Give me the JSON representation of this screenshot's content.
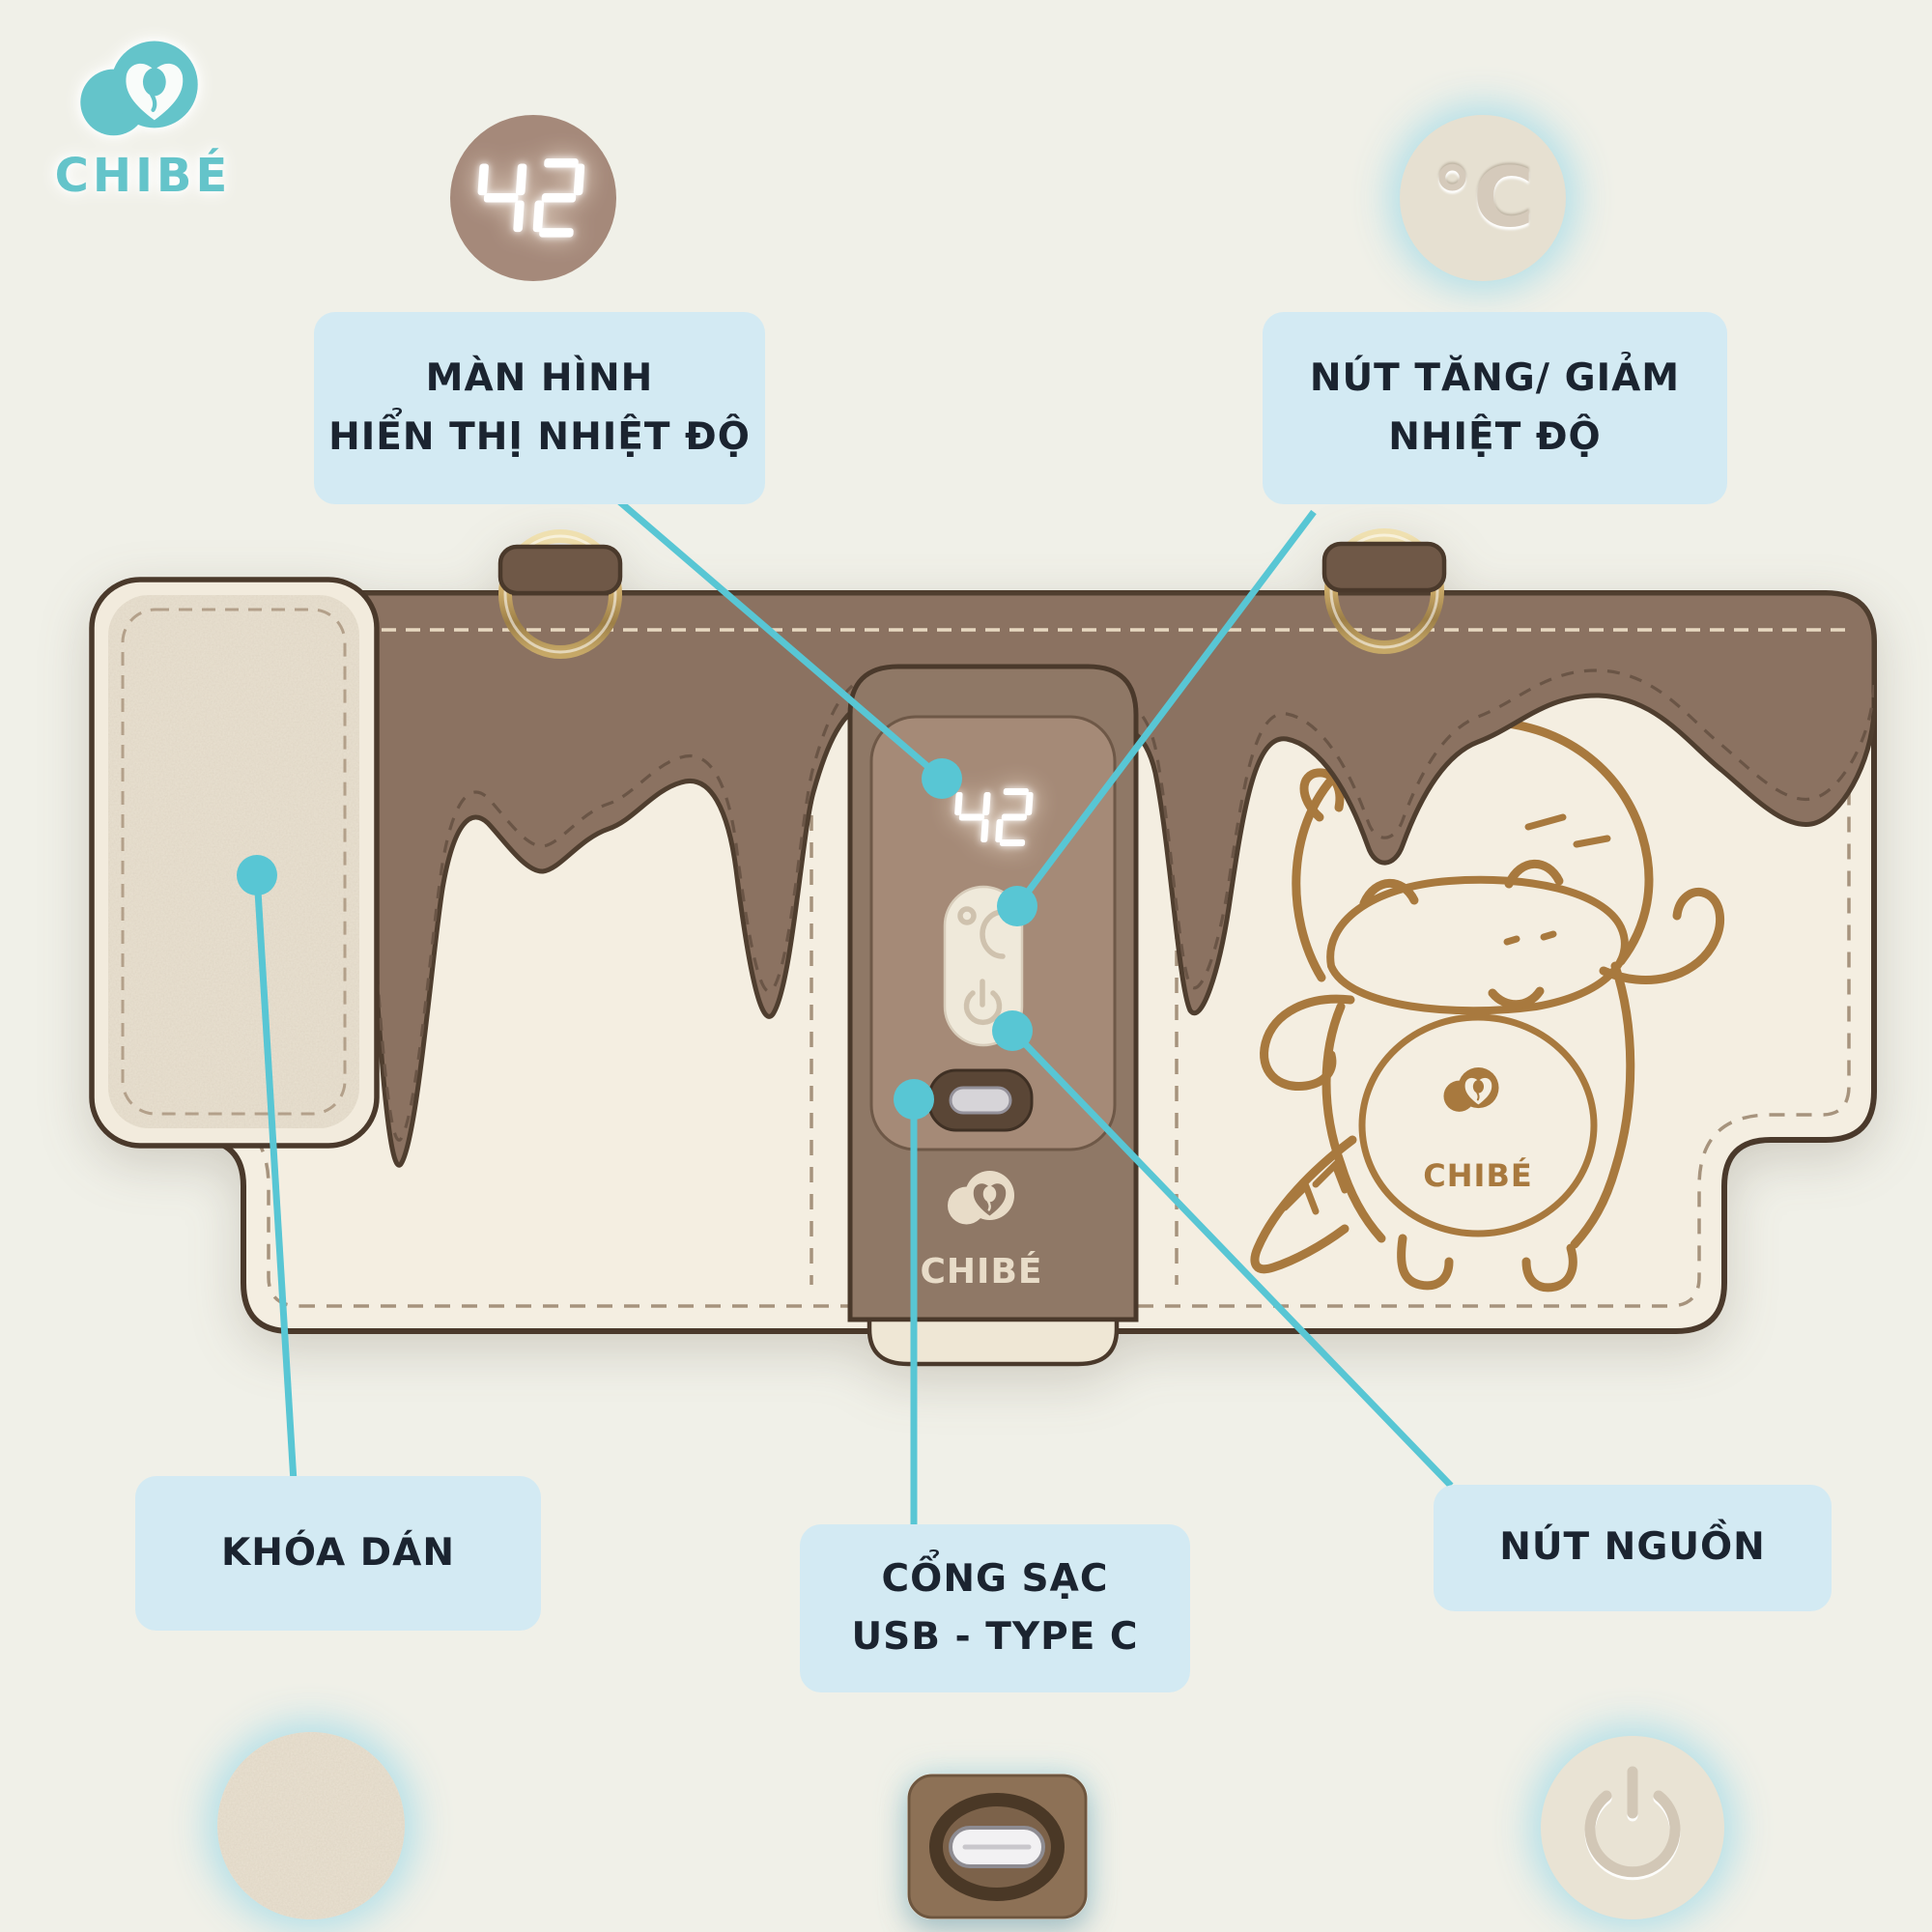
{
  "brand": {
    "name": "CHIBÉ"
  },
  "badges": {
    "temp_display_value": "42",
    "temp_unit": "°C"
  },
  "device": {
    "display_value": "42",
    "strip_logo_text": "CHIBÉ",
    "mascot_logo_text": "CHIBÉ"
  },
  "callouts": {
    "screen": {
      "line1": "MÀN HÌNH",
      "line2": "HIỂN THỊ NHIỆT ĐỘ"
    },
    "temp_buttons": {
      "line1": "NÚT TĂNG/ GIẢM",
      "line2": "NHIỆT ĐỘ"
    },
    "velcro": {
      "line1": "KHÓA DÁN"
    },
    "charge_port": {
      "line1": "CỔNG SẠC",
      "line2": "USB - TYPE C"
    },
    "power": {
      "line1": "NÚT NGUỒN"
    }
  },
  "colors": {
    "background": "#f0f0e8",
    "callout_bg": "#d3eaf3",
    "callout_text": "#1b2430",
    "connector": "#58c6d4",
    "brand_teal": "#64c4ca",
    "band_brown": "#8b7261",
    "strip_brown": "#8f7866",
    "panel_brown": "#a58a77",
    "bag_cream": "#f4eee1",
    "gold": "#d9bd83",
    "mascot_line": "#a8793e"
  }
}
